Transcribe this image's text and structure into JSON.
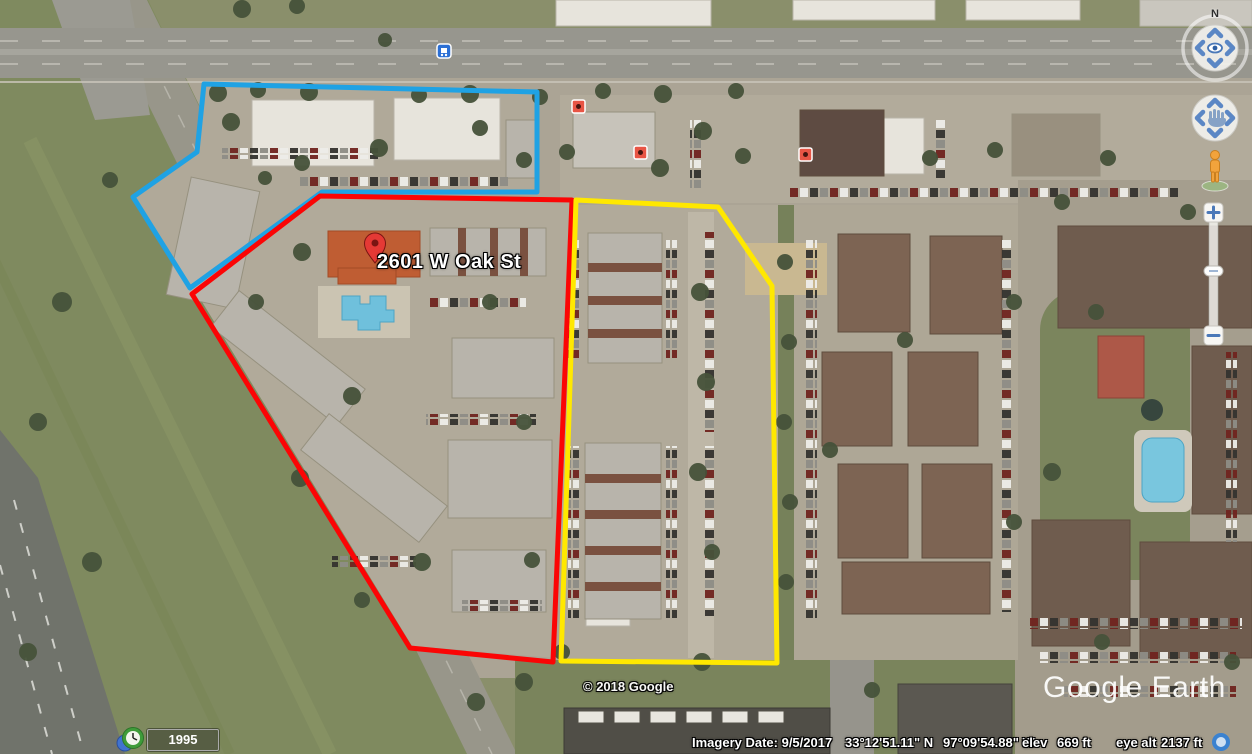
{
  "app": {
    "watermark": "Google Earth",
    "copyright": "© 2018 Google"
  },
  "placemark": {
    "label": "2601 W Oak St",
    "pin_color": "#e53935"
  },
  "status_bar": {
    "imagery_date": "Imagery Date: 9/5/2017",
    "latitude": "33°12'51.11\" N",
    "longitude": "97°09'54.88\" W",
    "elev_label": "elev",
    "elevation": "669 ft",
    "eye_alt_label": "eye alt",
    "eye_altitude": "2137 ft"
  },
  "timeline": {
    "year": "1995"
  },
  "navigation": {
    "compass_label": "N"
  },
  "annotations": {
    "blue_zone": {
      "color": "#1fa2e4",
      "points": "204,84 537,92 537,192 322,192 190,288 133,197 197,152"
    },
    "red_zone": {
      "color": "#fb0505",
      "points": "320,196 572,200 553,662 410,648 192,294"
    },
    "yellow_zone": {
      "color": "#ffe800",
      "points": "576,200 718,207 772,286 777,663 561,661"
    }
  }
}
